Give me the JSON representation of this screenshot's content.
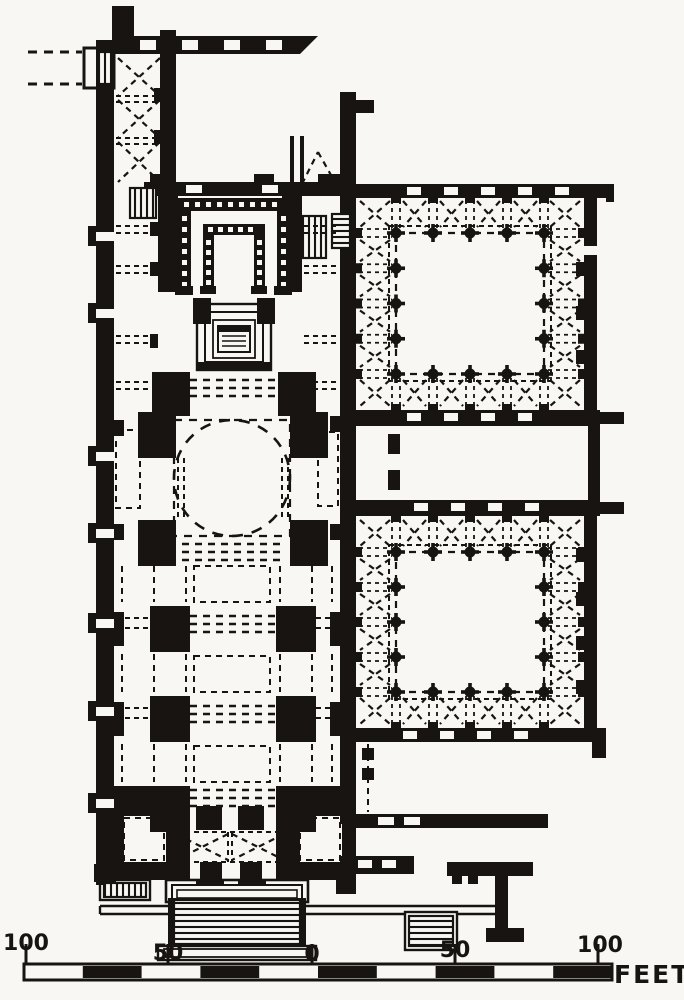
{
  "figure": {
    "kind": "architectural-floor-plan",
    "palette": {
      "ink": "#171411",
      "paper": "#f8f7f3"
    }
  },
  "scale_bar": {
    "tick_labels": [
      "100",
      "50",
      "0",
      "50",
      "100"
    ],
    "unit_label": "FEET"
  }
}
